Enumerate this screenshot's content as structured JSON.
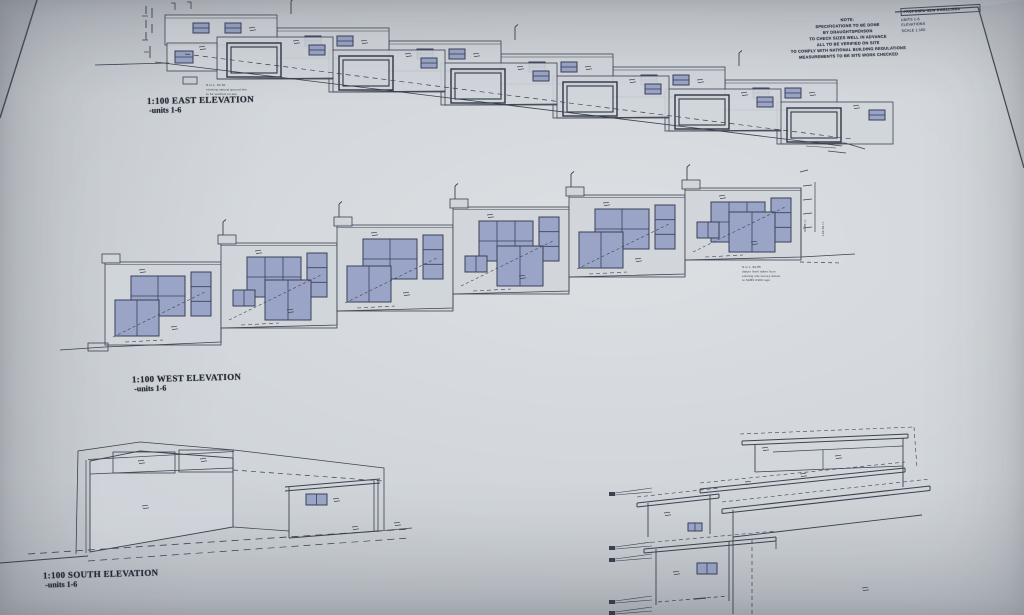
{
  "photo": {
    "description": "Photograph of an architectural elevations drawing sheet",
    "paper_color": "#ced3d8",
    "background_color": "#b9bec3",
    "line_color": "#3c4250",
    "heavy_line_color": "#2f3543",
    "window_glass_color": "#9aa4c6",
    "window_frame_color": "#39405a",
    "label_color": "#262b36"
  },
  "drawings": {
    "east": {
      "scale_label": "1:100 EAST ELEVATION",
      "units_label": "-units 1-6",
      "unit_count": 6,
      "ground_note": [
        "N.G.L. 64.30",
        "existing natural ground line",
        "to be verified on site"
      ]
    },
    "west": {
      "scale_label": "1:100 WEST ELEVATION",
      "units_label": "-units 1-6",
      "unit_count": 6,
      "level_note": [
        "N.G.L. 99.85",
        "datum level taken from",
        "existing site survey datum",
        "to SABS 0400 regs"
      ],
      "dim_texts": [
        "99.85 r.l.",
        "102.35 r.l."
      ]
    },
    "south": {
      "scale_label": "1:100 SOUTH ELEVATION",
      "units_label": "-units 1-6"
    },
    "section": {
      "flag_count": 5
    }
  },
  "notes": {
    "general": [
      "NOTE:",
      "SPECIFICATIONS TO BE DONE",
      "BY DRAUGHTSPERSON",
      "TO CHECK SIZES WELL IN ADVANCE",
      "ALL TO BE VERIFIED ON SITE",
      "TO COMPLY WITH NATIONAL BUILDING REGULATIONS",
      "MEASUREMENTS TO BE SITE WORK CHECKED"
    ]
  },
  "title_block": {
    "lines": [
      "PROPOSED NEW DWELLINGS",
      "UNITS 1-6",
      "ELEVATIONS",
      "SCALE 1:100"
    ]
  }
}
